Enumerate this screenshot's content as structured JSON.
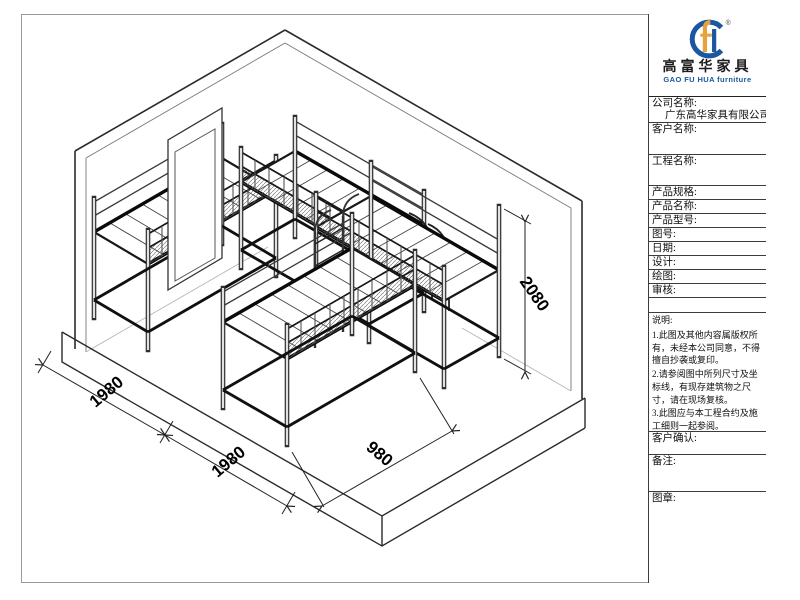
{
  "panel": {
    "logo": {
      "brand_cn": "高富华家具",
      "brand_en": "GAO FU HUA furniture",
      "registered": "®"
    },
    "fields": [
      {
        "label": "公司名称:",
        "value": "广东高华家具有限公司"
      },
      {
        "label": "客户名称:",
        "value": ""
      },
      {
        "label": "工程名称:",
        "value": ""
      },
      {
        "label": "产品规格:",
        "value": ""
      },
      {
        "label": "产品名称:",
        "value": ""
      },
      {
        "label": "产品型号:",
        "value": ""
      },
      {
        "label": "图号:",
        "value": ""
      },
      {
        "label": "日期:",
        "value": ""
      },
      {
        "label": "设计:",
        "value": ""
      },
      {
        "label": "绘图:",
        "value": ""
      },
      {
        "label": "审核:",
        "value": ""
      }
    ],
    "notes_label": "说明:",
    "notes": [
      "1.此图及其他内容属版权所有，未经本公司同意，不得擅自抄袭或复印。",
      "2.请参阅图中所列尺寸及坐标线，有现存建筑物之尺寸，请在现场复核。",
      "3.此图应与本工程合约及施工细则一起参阅。",
      "4.此图内容与以下工程合约有关。"
    ],
    "confirm_label": "客户确认:",
    "remark_label": "备注:",
    "stamp_label": "图章:"
  },
  "drawing": {
    "dimensions": {
      "bay1_width": "1980",
      "bay2_width": "1980",
      "bed_depth": "980",
      "bed_height": "2080"
    }
  }
}
